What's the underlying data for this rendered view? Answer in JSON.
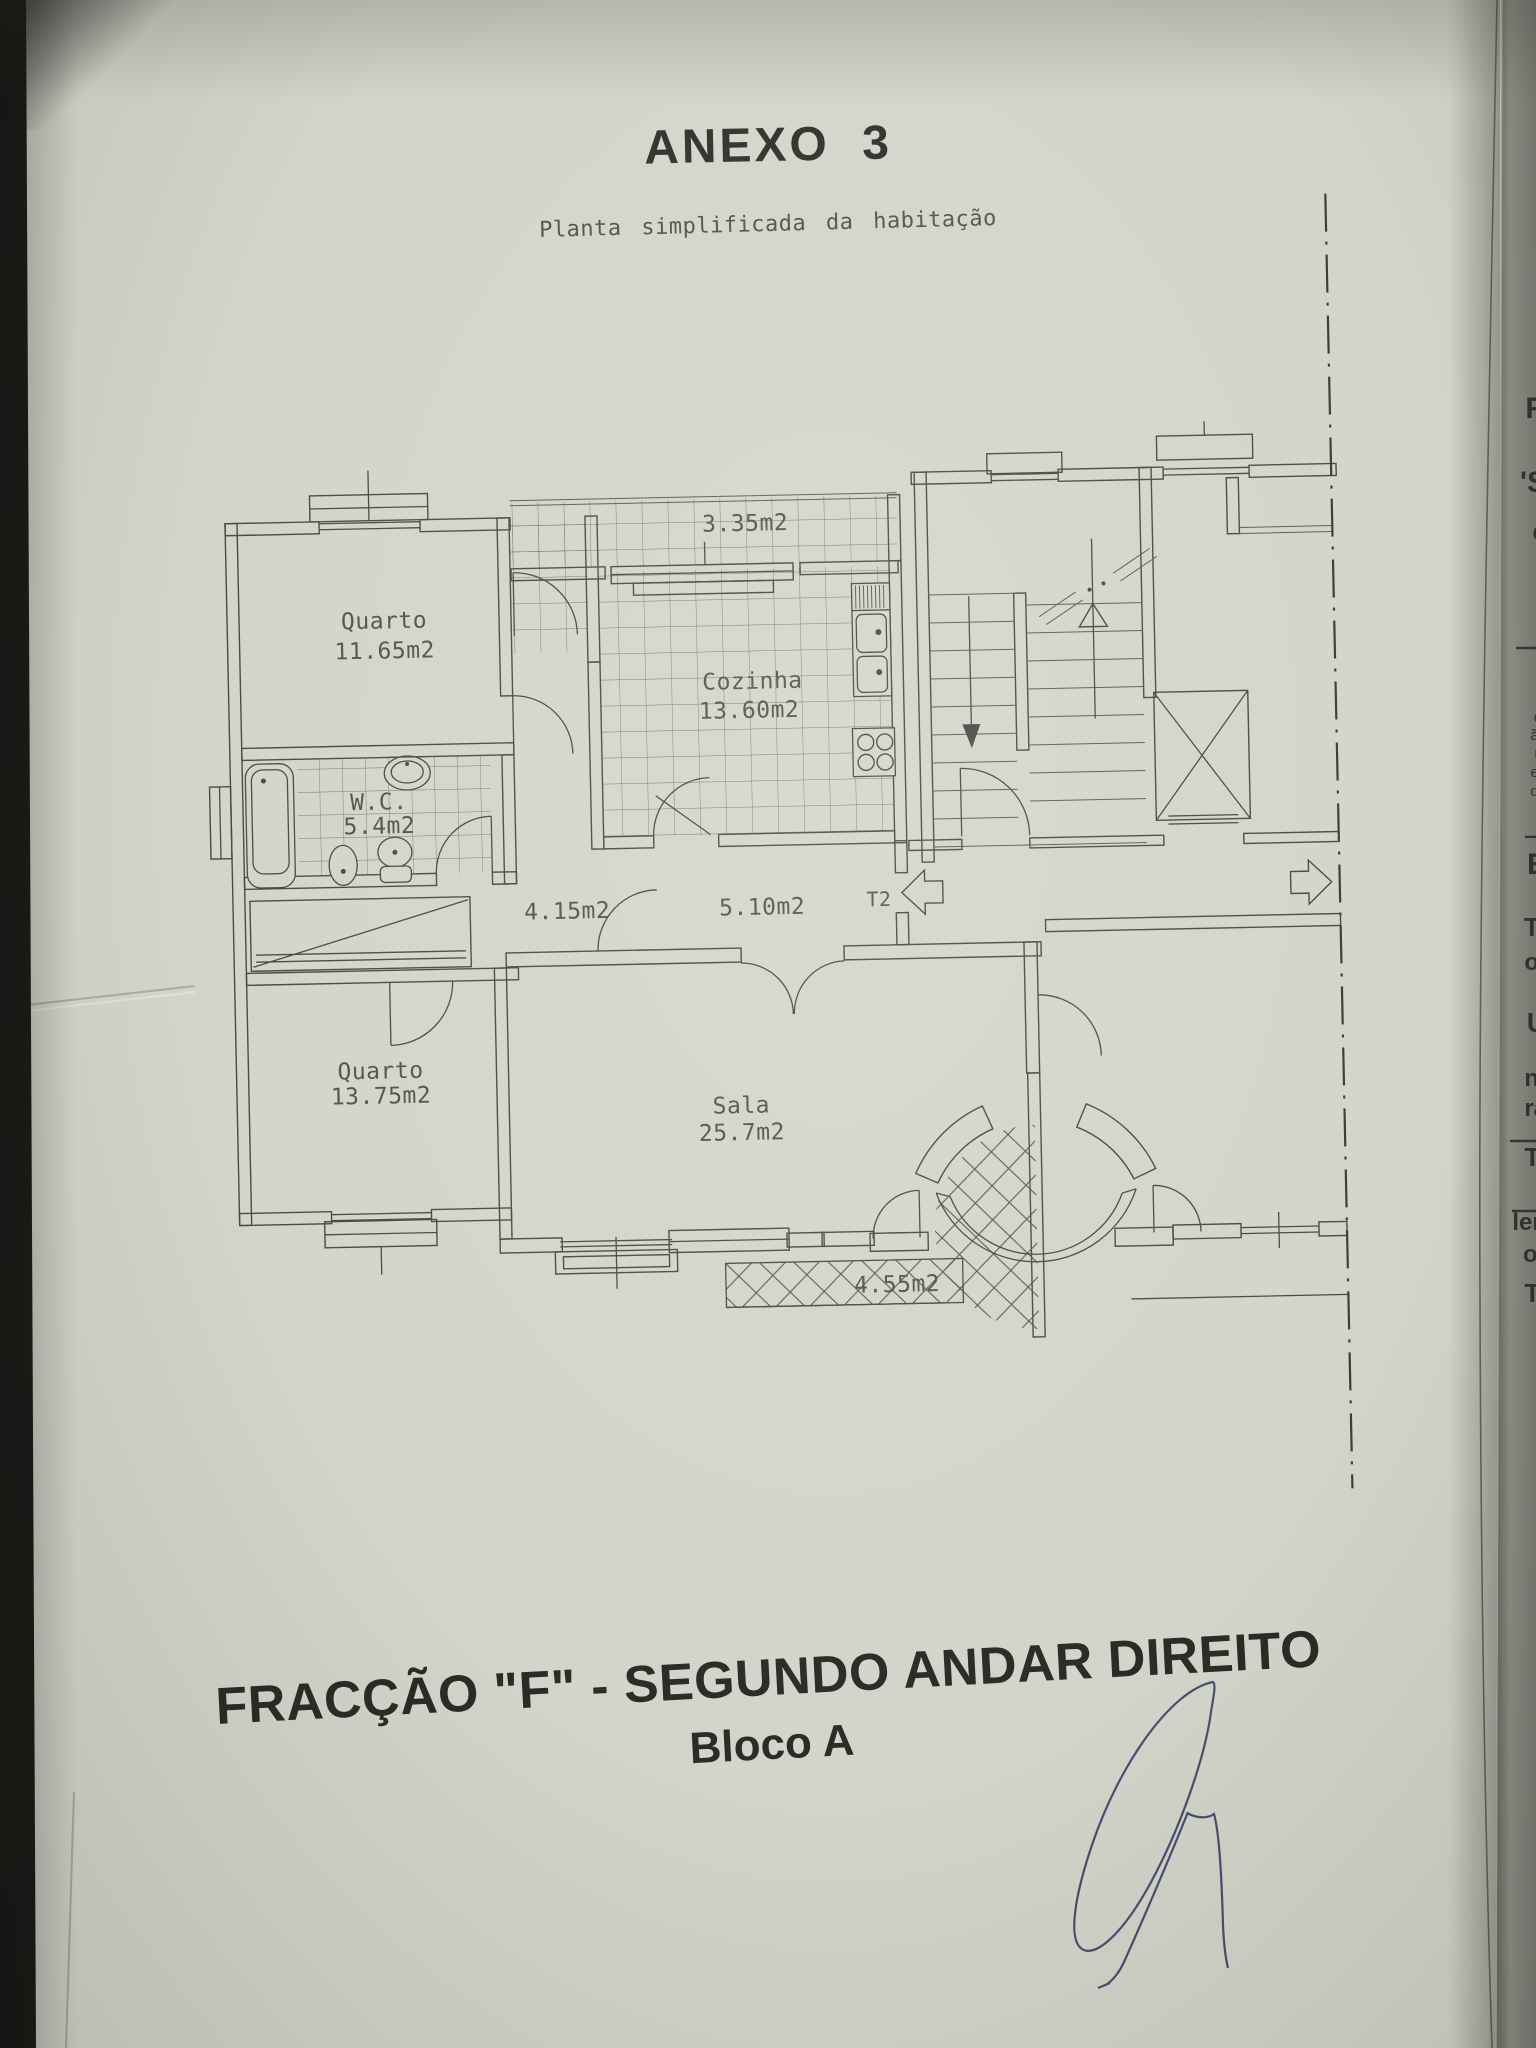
{
  "page": {
    "title": "ANEXO 3",
    "subtitle": "Planta simplificada da habitação",
    "footer_line1": "FRACÇÃO  \"F\" - SEGUNDO ANDAR DIREITO",
    "footer_line2": "Bloco A"
  },
  "plan": {
    "rooms": [
      {
        "name": "Quarto",
        "area": "11.65m2"
      },
      {
        "name": "Cozinha",
        "area": "13.60m2"
      },
      {
        "name": "W.C.",
        "area": "5.4m2"
      },
      {
        "name": "Quarto",
        "area": "13.75m2"
      },
      {
        "name": "Sala",
        "area": "25.7m2"
      }
    ],
    "zones": [
      {
        "label": "3.35m2"
      },
      {
        "label": "4.15m2"
      },
      {
        "label": "5.10m2"
      },
      {
        "label": "4.55m2"
      }
    ],
    "type_label": "T2"
  },
  "edge_fragments": [
    {
      "text": "R",
      "y": 418,
      "size": 30,
      "bold": true
    },
    {
      "text": "'S",
      "y": 492,
      "size": 30,
      "bold": true
    },
    {
      "text": "e",
      "y": 540,
      "size": 26,
      "bold": true
    },
    {
      "text": "I",
      "y": 582,
      "size": 26,
      "bold": true
    },
    {
      "text": "I",
      "y": 620,
      "size": 26,
      "bold": true
    },
    {
      "text": "3",
      "y": 662,
      "size": 20,
      "bold": false
    },
    {
      "text": "or",
      "y": 722,
      "size": 15,
      "bold": false
    },
    {
      "text": "ão",
      "y": 740,
      "size": 15,
      "bold": false
    },
    {
      "text": "nt",
      "y": 758,
      "size": 15,
      "bold": false
    },
    {
      "text": "en",
      "y": 777,
      "size": 15,
      "bold": false
    },
    {
      "text": "do",
      "y": 796,
      "size": 15,
      "bold": false
    },
    {
      "text": "a",
      "y": 813,
      "size": 15,
      "bold": false
    },
    {
      "text": "—",
      "y": 843,
      "size": 22,
      "bold": true
    },
    {
      "text": "E",
      "y": 874,
      "size": 30,
      "bold": true
    },
    {
      "text": "Tl",
      "y": 936,
      "size": 26,
      "bold": true
    },
    {
      "text": "o:",
      "y": 970,
      "size": 24,
      "bold": true
    },
    {
      "text": "U",
      "y": 1032,
      "size": 28,
      "bold": true
    },
    {
      "text": "nt",
      "y": 1086,
      "size": 24,
      "bold": true
    },
    {
      "text": "ra",
      "y": 1116,
      "size": 24,
      "bold": true
    },
    {
      "text": "Ti",
      "y": 1166,
      "size": 26,
      "bold": true
    },
    {
      "text": "len",
      "y": 1230,
      "size": 24,
      "bold": true
    },
    {
      "text": "or",
      "y": 1262,
      "size": 24,
      "bold": true
    },
    {
      "text": "Ti",
      "y": 1302,
      "size": 26,
      "bold": true
    }
  ],
  "colors": {
    "paper": "#d4d5ca",
    "ink": "#4a4a44",
    "label": "#54544c",
    "title": "#30302c",
    "signature": "#3d4468",
    "under_page": "#8f9086"
  }
}
